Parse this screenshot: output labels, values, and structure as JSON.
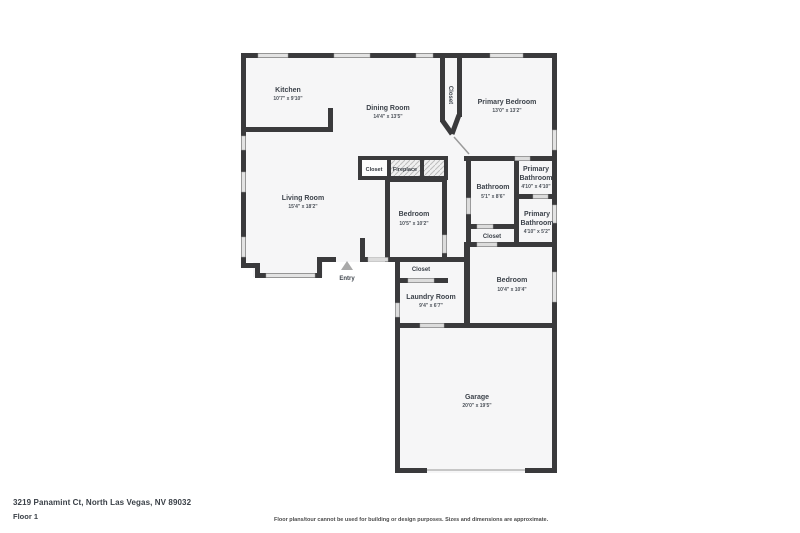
{
  "footer": {
    "address": "3219 Panamint Ct, North Las Vegas, NV 89032",
    "floor_label": "Floor 1",
    "disclaimer": "Floor plans/tour cannot be used for building or design purposes. Sizes and dimensions are approximate."
  },
  "colors": {
    "wall": "#3a3a3c",
    "room_fill": "#f6f6f7",
    "window_fill": "#e3e3e3",
    "door_fill": "#dcdcdc",
    "label_text": "#3d434b",
    "dims_text": "#4c525a",
    "entry_arrow": "#a9a9a9"
  },
  "rooms": {
    "kitchen": {
      "name": "Kitchen",
      "dims": "10'7\" x 9'10\""
    },
    "dining": {
      "name": "Dining Room",
      "dims": "14'4\" x 13'5\""
    },
    "closet_hall": {
      "name": "Closet"
    },
    "primary_bedroom": {
      "name": "Primary Bedroom",
      "dims": "13'0\" x 13'2\""
    },
    "living": {
      "name": "Living Room",
      "dims": "15'4\" x 18'2\""
    },
    "closet_fp": {
      "name": "Closet"
    },
    "fireplace": {
      "name": "Fireplace"
    },
    "bedroom_mid": {
      "name": "Bedroom",
      "dims": "10'5\" x 10'2\""
    },
    "bathroom": {
      "name": "Bathroom",
      "dims": "5'1\" x 8'6\""
    },
    "primary_bath_1": {
      "line1": "Primary",
      "line2": "Bathroom",
      "dims": "4'10\" x 4'10\""
    },
    "primary_bath_2": {
      "line1": "Primary",
      "line2": "Bathroom",
      "dims": "4'10\" x 5'2\""
    },
    "closet_bath": {
      "name": "Closet"
    },
    "entry": {
      "name": "Entry"
    },
    "closet_laundry": {
      "name": "Closet"
    },
    "laundry": {
      "name": "Laundry Room",
      "dims": "9'4\" x 6'7\""
    },
    "bedroom_low": {
      "name": "Bedroom",
      "dims": "10'4\" x 10'4\""
    },
    "garage": {
      "name": "Garage",
      "dims": "20'0\" x 19'5\""
    }
  }
}
